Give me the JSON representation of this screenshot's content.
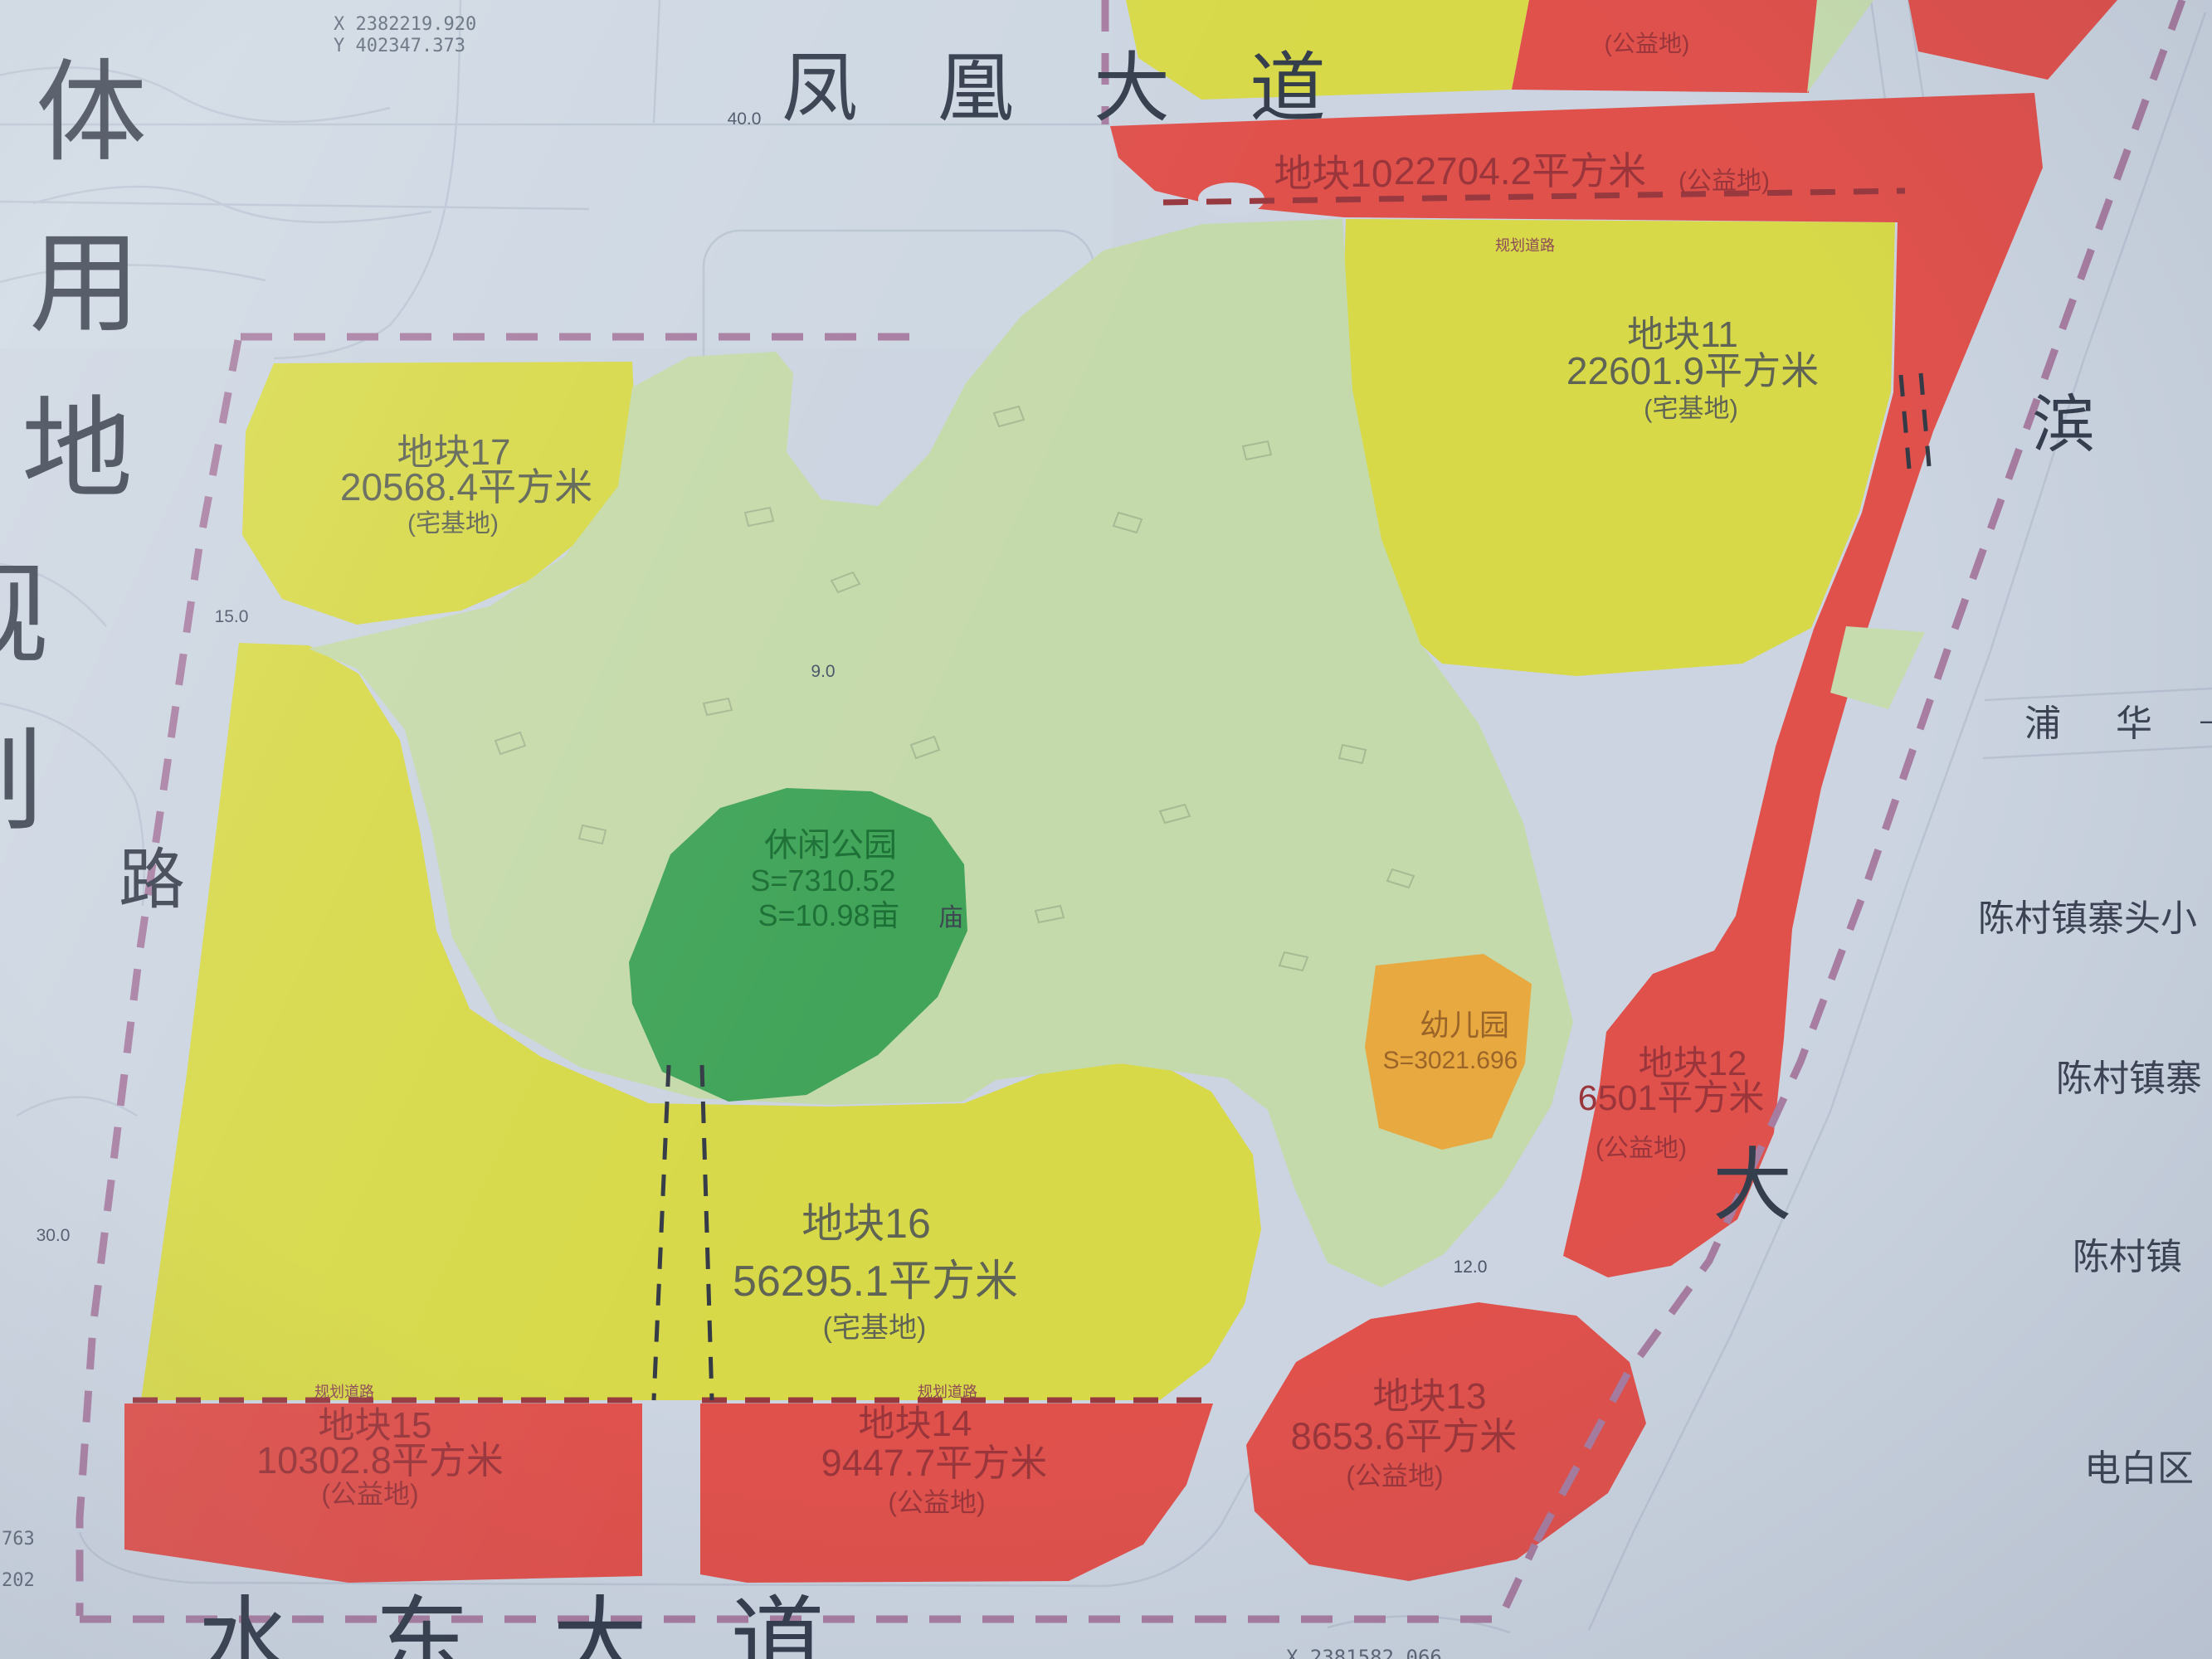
{
  "left_title": {
    "chars": [
      "体",
      "用",
      "地",
      "规",
      "划"
    ]
  },
  "left_road_char": "路",
  "top_road": {
    "label": "凤凰大道"
  },
  "bottom_road": {
    "label": "水东大道"
  },
  "right_road": {
    "chars": [
      "滨",
      "大"
    ]
  },
  "puhua_road": {
    "chars": [
      "浦",
      "华"
    ],
    "dash": "—"
  },
  "coords": {
    "top_x": "X 2382219.920",
    "top_y": "Y 402347.373",
    "bottom_x": "X 2381582.066",
    "left_partials": [
      "763",
      "202"
    ]
  },
  "parcels": {
    "p10": {
      "name": "地块10",
      "area": "22704.2平方米",
      "type": "(公益地)"
    },
    "p11": {
      "name": "地块11",
      "area": "22601.9平方米",
      "type": "(宅基地)"
    },
    "p12": {
      "name": "地块12",
      "area": "6501平方米",
      "type": "(公益地)"
    },
    "p13": {
      "name": "地块13",
      "area": "8653.6平方米",
      "type": "(公益地)"
    },
    "p14": {
      "name": "地块14",
      "area": "9447.7平方米",
      "type": "(公益地)"
    },
    "p15": {
      "name": "地块15",
      "area": "10302.8平方米",
      "type": "(公益地)"
    },
    "p16": {
      "name": "地块16",
      "area": "56295.1平方米",
      "type": "(宅基地)"
    },
    "p17": {
      "name": "地块17",
      "area": "20568.4平方米",
      "type": "(宅基地)"
    },
    "north": {
      "type": "(公益地)"
    }
  },
  "park": {
    "name": "休闲公园",
    "area_m2": "S=7310.52",
    "area_mu": "S=10.98亩"
  },
  "kindergarten": {
    "name": "幼儿园",
    "area": "S=3021.696"
  },
  "temple_char": "庙",
  "right_labels": [
    "陈村镇寨头小",
    "陈村镇寨",
    "陈村镇",
    "电白区"
  ],
  "planning_road_label": "规划道路",
  "dims": {
    "d40": "40.0",
    "d15": "15.0",
    "d9": "9.0",
    "d30": "30.0",
    "d12": "12.0"
  },
  "colors": {
    "paper": "#cbd4e0",
    "red_parcel": "#e4504b",
    "yellow_parcel": "#d7d945",
    "village_green": "#c5daa9",
    "park_green": "#3fa558",
    "kindergarten_orange": "#e9a93d",
    "boundary_purple": "#a87da2",
    "ink": "#39404e",
    "red_text": "#9c353a"
  }
}
